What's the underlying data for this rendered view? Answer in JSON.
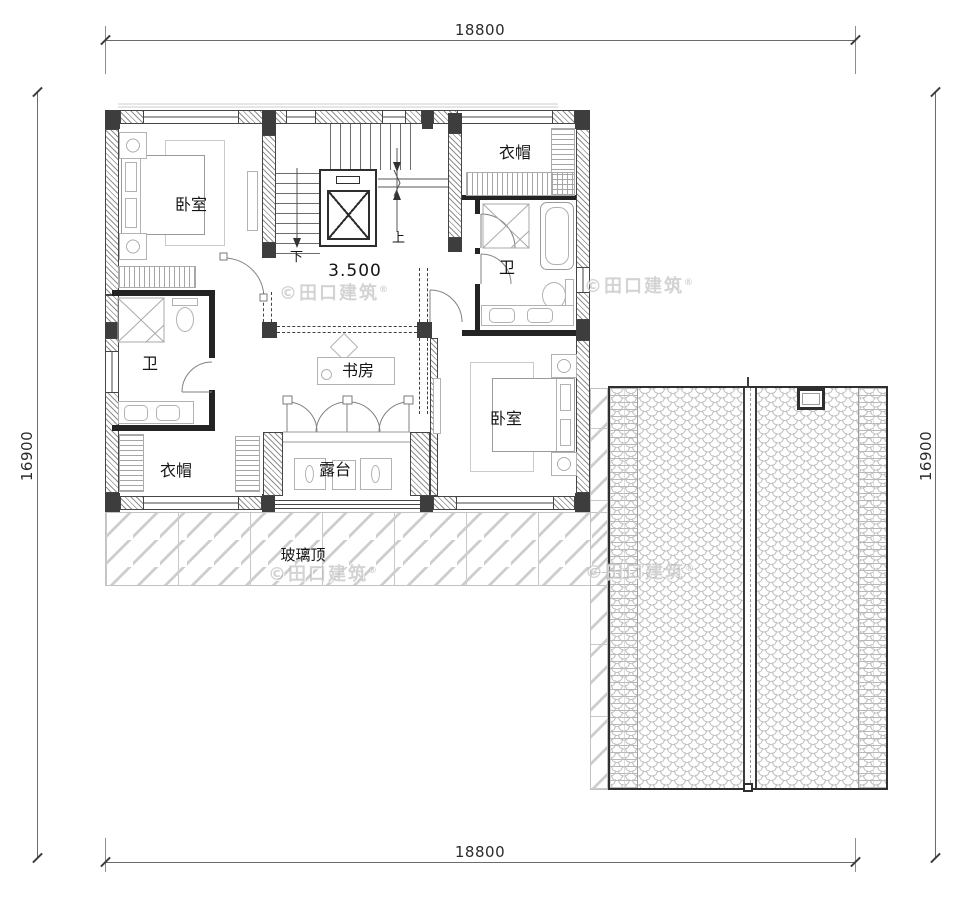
{
  "dimensions": {
    "top": "18800",
    "bottom": "18800",
    "left": "16900",
    "right": "16900"
  },
  "level_label": "3.500",
  "stair": {
    "down": "下",
    "up": "上"
  },
  "rooms": {
    "bedroom_tl": "卧室",
    "closet_tr": "衣帽",
    "bath_tr": "卫",
    "study": "书房",
    "bath_left": "卫",
    "closet_bl": "衣帽",
    "terrace": "露台",
    "bedroom_br": "卧室",
    "glass_roof": "玻璃顶"
  },
  "watermark": {
    "text": "©田口建筑",
    "reg": "®"
  },
  "colors": {
    "line": "#454545",
    "wall_dark": "#3d3d3d",
    "furniture": "#b2b2b2",
    "roof_tile": "#c3c3c3",
    "watermark": "#cfcfcf"
  }
}
